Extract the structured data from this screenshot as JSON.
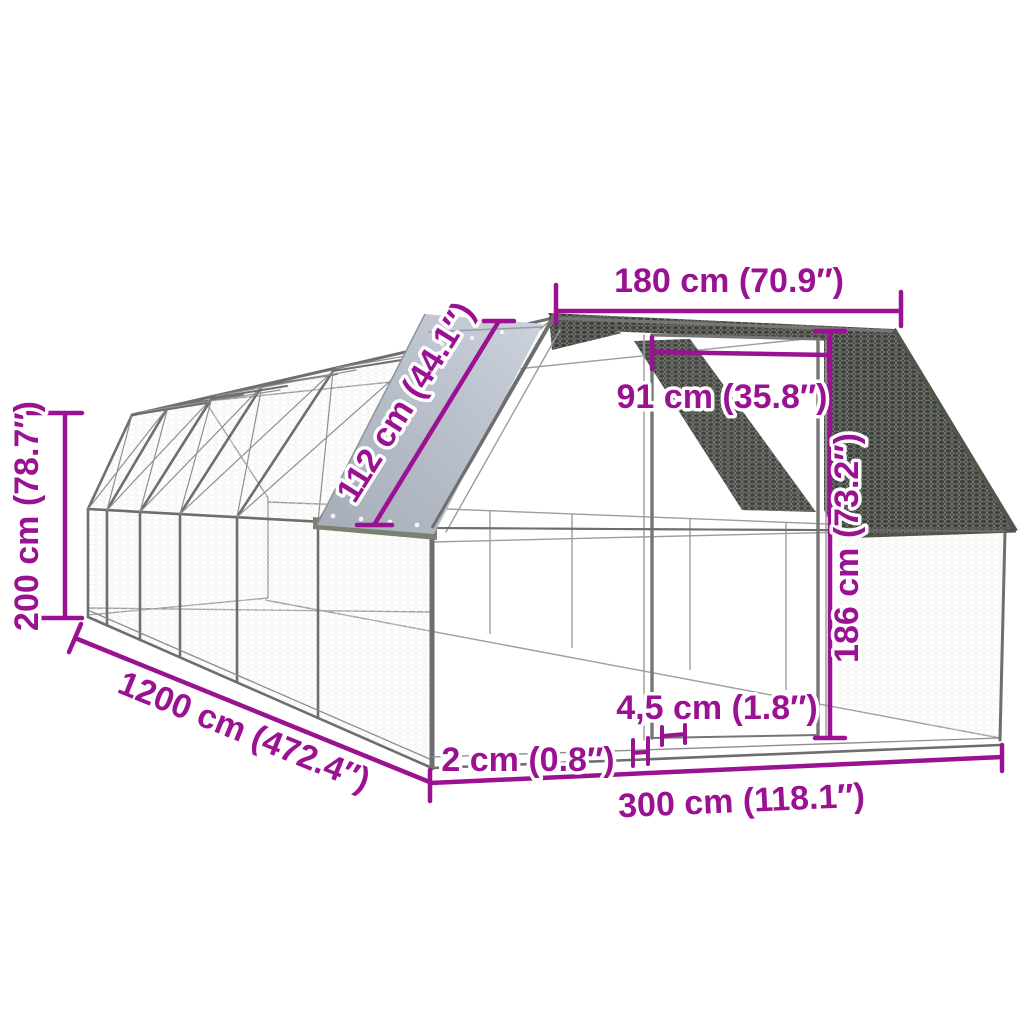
{
  "diagram": {
    "colors": {
      "dimension_accent": "#9A1191",
      "frame_gray": "#6e6e6e",
      "mesh_dark": "#3e413d",
      "tarp_light": "#ccd2db",
      "tarp_dark": "#a9b0bc",
      "tarp_hem_olive": "#7a8171",
      "background": "#ffffff"
    },
    "dimensions": {
      "top_width": "180 cm (70.9″)",
      "door_width": "91 cm (35.8″)",
      "roof_cover": "112 cm (44.1″)",
      "total_height": "200 cm (78.7″)",
      "total_length": "1200 cm (472.4″)",
      "wall_height": "186 cm (73.2″)",
      "gap_small": "4,5 cm (1.8″)",
      "tube_small": "2 cm (0.8″)",
      "front_width": "300 cm (118.1″)"
    }
  }
}
